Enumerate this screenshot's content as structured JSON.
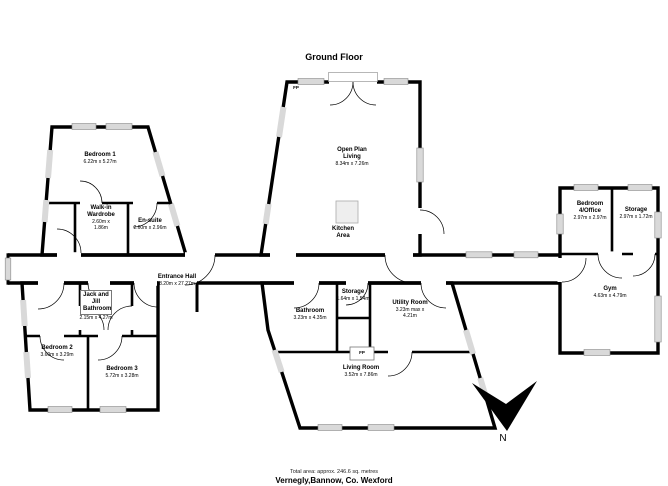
{
  "title": "Ground Floor",
  "rooms": {
    "bedroom1": {
      "name": "Bedroom 1",
      "dims": "6.22m x 5.27m"
    },
    "walk_in_wardrobe": {
      "name": "Walk-in Wardrobe",
      "dims": "2.60m x 1.86m"
    },
    "en_suite": {
      "name": "En-suite",
      "dims": "2.60m x 2.96m"
    },
    "entrance_hall": {
      "name": "Entrance Hall",
      "dims": "8.20m x 27.27m"
    },
    "jack_and_jill": {
      "name": "Jack and Jill Bathroom",
      "dims": "2.15m x 4.27m"
    },
    "bedroom2": {
      "name": "Bedroom 2",
      "dims": "3.60m x 3.29m"
    },
    "bedroom3": {
      "name": "Bedroom 3",
      "dims": "5.72m x 3.28m"
    },
    "open_plan_living": {
      "name": "Open Plan Living",
      "dims": "8.34m x 7.26m"
    },
    "kitchen_area": {
      "name": "Kitchen Area"
    },
    "bathroom": {
      "name": "Bathroom",
      "dims": "3.23m x 4.35m"
    },
    "storage_mid": {
      "name": "Storage",
      "dims": "1.64m x 1.54m"
    },
    "utility_room": {
      "name": "Utility Room",
      "dims": "3.23m max x 4.21m"
    },
    "living_room": {
      "name": "Living Room",
      "dims": "3.52m x 7.86m"
    },
    "bedroom4_office": {
      "name": "Bedroom 4/Office",
      "dims": "2.97m x 2.97m"
    },
    "storage_right": {
      "name": "Storage",
      "dims": "2.97m x 1.72m"
    },
    "gym": {
      "name": "Gym",
      "dims": "4.63m x 4.79m"
    }
  },
  "markers": {
    "fireplace": "FP"
  },
  "north": {
    "label": "N"
  },
  "footer": {
    "total_area": "Total area: approx. 246.6 sq. metres",
    "address": "Vernegly,Bannow, Co. Wexford"
  },
  "colors": {
    "wall": "#000000",
    "window": "#d9d9d9",
    "room_fill": "#ffffff"
  }
}
